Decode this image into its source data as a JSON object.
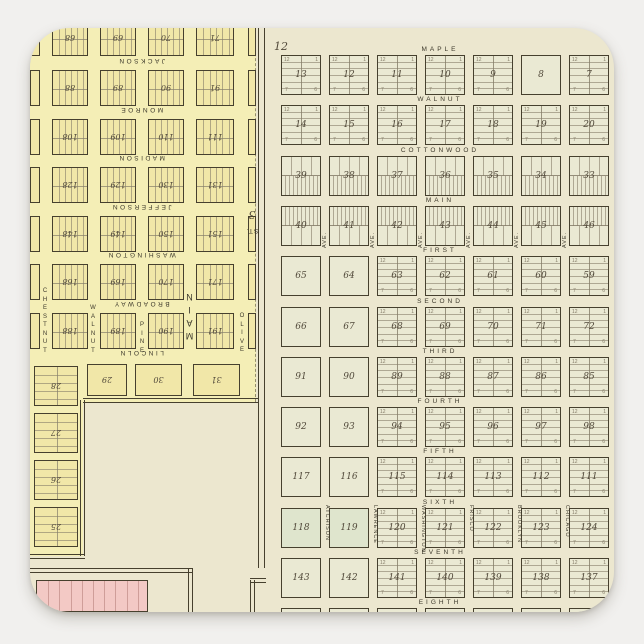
{
  "page": {
    "bg": "#f1f0ee"
  },
  "sticker": {
    "bg": "#ece7cf",
    "radius": 40
  },
  "colors": {
    "page_bg": "#f1f0ee",
    "sticker_bg": "#ece7cf",
    "left_bg": "#f4eeb6",
    "left_block": "#f1e7a8",
    "right_block": "#eae9d3",
    "green_block": "#dfe5cd",
    "pink": "#f3c9c5",
    "pink_line": "#cf9e99",
    "line": "#46402e",
    "faint": "#857d69",
    "text": "#3c382b",
    "number": "#51493a"
  },
  "left_map": {
    "h_streets": [
      "JACKSON",
      "MONROE",
      "MADISON",
      "JEFFERSON",
      "WASHINGTON",
      "BROADWAY",
      "LINCOLN"
    ],
    "v_streets": [
      "CHESTNUT",
      "WALNUT",
      "PINE",
      "OLIVE"
    ],
    "main_street": "MAIN",
    "road_labels": {
      "st": "ST.",
      "num": "3"
    },
    "top_row": [
      "68",
      "69",
      "70",
      "71"
    ],
    "rows": [
      [
        "88",
        "89",
        "90",
        "91"
      ],
      [
        "108",
        "109",
        "110",
        "111"
      ],
      [
        "128",
        "129",
        "130",
        "131"
      ],
      [
        "148",
        "149",
        "150",
        "151"
      ],
      [
        "168",
        "169",
        "170",
        "171"
      ],
      [
        "188",
        "189",
        "190",
        "191"
      ]
    ],
    "south_row": [
      "29",
      "30",
      "31"
    ],
    "west_column": [
      "28",
      "27",
      "26",
      "25"
    ]
  },
  "right_map": {
    "section_label": "12",
    "h_streets": [
      "MAPLE",
      "WALNUT",
      "COTTONWOOD",
      "MAIN",
      "FIRST",
      "SECOND",
      "THIRD",
      "FOURTH",
      "FIFTH",
      "SIXTH",
      "SEVENTH",
      "EIGHTH"
    ],
    "sixth_v_streets": [
      "ATCHISON",
      "LAWRENCE",
      "WASHINGTON",
      "FRISCO",
      "BROOKLYN",
      "CHICAGO"
    ],
    "ave_label": "AVE.",
    "lot_corner_numbers": {
      "tl": "12",
      "tr": "1",
      "bl": "7",
      "br": "6"
    },
    "rows": [
      {
        "blocks": [
          "13",
          "12",
          "11",
          "10",
          "9",
          "8",
          "7"
        ],
        "type": "h6",
        "empty": [
          "8"
        ]
      },
      {
        "blocks": [
          "14",
          "15",
          "16",
          "17",
          "18",
          "19",
          "20"
        ],
        "type": "h6",
        "empty": []
      },
      {
        "blocks": [
          "39",
          "38",
          "37",
          "36",
          "35",
          "34",
          "33"
        ],
        "type": "biz",
        "dense": "bottom",
        "empty": []
      },
      {
        "blocks": [
          "40",
          "41",
          "42",
          "43",
          "44",
          "45",
          "46"
        ],
        "type": "biz",
        "dense": "top",
        "empty": [],
        "ave_labels": true
      },
      {
        "blocks": [
          "65",
          "64",
          "63",
          "62",
          "61",
          "60",
          "59"
        ],
        "type": "h6",
        "empty": [
          "65",
          "64"
        ]
      },
      {
        "blocks": [
          "66",
          "67",
          "68",
          "69",
          "70",
          "71",
          "72"
        ],
        "type": "h6",
        "empty": [
          "66",
          "67"
        ]
      },
      {
        "blocks": [
          "91",
          "90",
          "89",
          "88",
          "87",
          "86",
          "85"
        ],
        "type": "h6",
        "empty": [
          "91",
          "90"
        ]
      },
      {
        "blocks": [
          "92",
          "93",
          "94",
          "95",
          "96",
          "97",
          "98"
        ],
        "type": "h6",
        "empty": [
          "92",
          "93"
        ]
      },
      {
        "blocks": [
          "117",
          "116",
          "115",
          "114",
          "113",
          "112",
          "111"
        ],
        "type": "h6",
        "empty": [
          "117",
          "116"
        ]
      },
      {
        "blocks": [
          "118",
          "119",
          "120",
          "121",
          "122",
          "123",
          "124"
        ],
        "type": "h6",
        "empty": [
          "118",
          "119"
        ],
        "green": [
          "118",
          "119"
        ],
        "street_names": true
      },
      {
        "blocks": [
          "143",
          "142",
          "141",
          "140",
          "139",
          "138",
          "137"
        ],
        "type": "h6",
        "empty": [
          "143",
          "142"
        ]
      }
    ]
  }
}
